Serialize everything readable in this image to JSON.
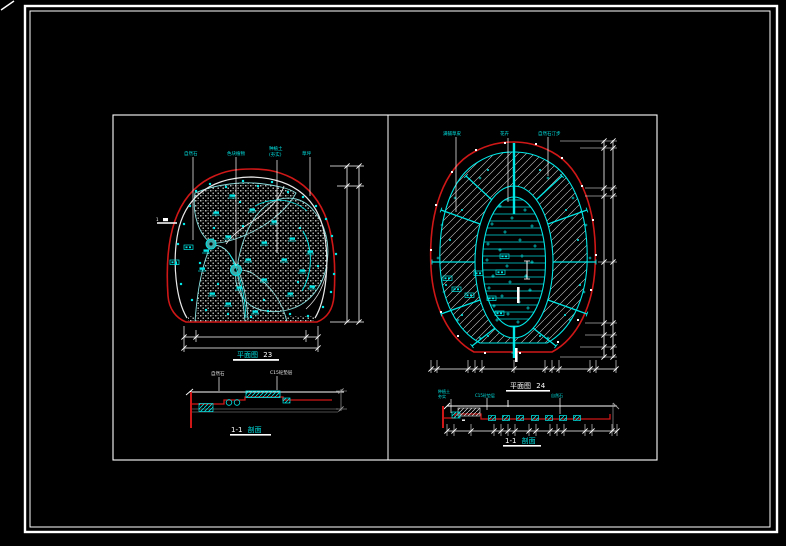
{
  "sheet": {
    "description_marker": "1",
    "left_view": {
      "title": {
        "name": "平面图",
        "num": "23"
      },
      "top_labels": [
        "自然石",
        "色块植物",
        "种植土",
        "(夯实)",
        "草坪"
      ],
      "section_labels": [
        "自然石",
        "C15砼垫层"
      ],
      "section_title": {
        "prefix": "1-1",
        "suffix": "剖面"
      }
    },
    "right_view": {
      "title": {
        "name": "平面图",
        "num": "24"
      },
      "top_labels": [
        "满铺草皮",
        "花卉",
        "自然石汀步"
      ],
      "section_labels": [
        "种植土",
        "夯实",
        "C15砼垫层",
        "自然石"
      ],
      "section_title": {
        "prefix": "1-1",
        "suffix": "剖面"
      }
    }
  },
  "colors": {
    "bg": "#000000",
    "red": "#cf1717",
    "cyan": "#00e5e5",
    "cyan_soft": "#7fd8d8",
    "white": "#ffffff",
    "off_white": "#dddddd",
    "hatch_gray": "#b9bdb9",
    "dim_gray": "#9a9a9a"
  }
}
